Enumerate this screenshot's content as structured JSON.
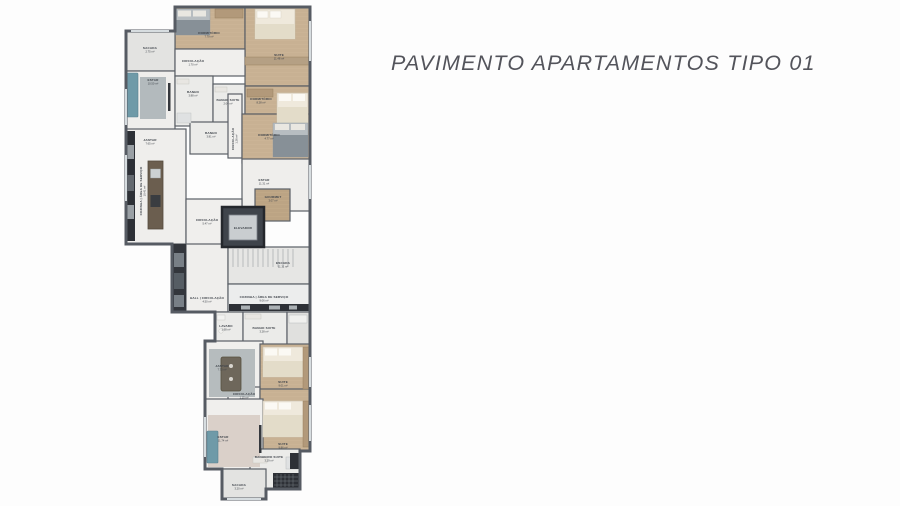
{
  "title": "PAVIMENTO APARTAMENTOS TIPO 01",
  "floorplan": {
    "rooms": [
      {
        "name": "SACADA",
        "area": "2.75 m²"
      },
      {
        "name": "DORMITÓRIO",
        "area": "7.79 m²"
      },
      {
        "name": "SUITE",
        "area": "11.48 m²"
      },
      {
        "name": "CIRCULAÇÃO",
        "area": "1.70 m²"
      },
      {
        "name": "ESTAR",
        "area": "10.50 m²"
      },
      {
        "name": "BANHO",
        "area": "3.88 m²"
      },
      {
        "name": "BANHO SUITE",
        "area": "2.04 m²"
      },
      {
        "name": "DORMITÓRIO",
        "area": "8.28 m²"
      },
      {
        "name": "JANTAR",
        "area": "7.65 m²"
      },
      {
        "name": "BANHO",
        "area": "3.81 m²"
      },
      {
        "name": "CIRCULAÇÃO",
        "area": "1.26 m²"
      },
      {
        "name": "DORMITÓRIO",
        "area": "4.77 m²"
      },
      {
        "name": "COZINHA | ÁREA DE SERVIÇO",
        "area": "10.41 m²"
      },
      {
        "name": "ESTAR",
        "area": "11.31 m²"
      },
      {
        "name": "GOURMET",
        "area": "3.07 m²"
      },
      {
        "name": "CIRCULAÇÃO",
        "area": "5.47 m²"
      },
      {
        "name": "ELEVADOR",
        "area": ""
      },
      {
        "name": "ESCADA",
        "area": "11.11 m²"
      },
      {
        "name": "COZINHA | ÁREA DE SERVIÇO",
        "area": "9.06 m²"
      },
      {
        "name": "HALL | CIRCULAÇÃO",
        "area": "4.50 m²"
      },
      {
        "name": "LAVABO",
        "area": "1.68 m²"
      },
      {
        "name": "BANHO SUITE",
        "area": "3.28 m²"
      },
      {
        "name": "JANTAR",
        "area": "7.73 m²"
      },
      {
        "name": "SUITE",
        "area": "9.01 m²"
      },
      {
        "name": "CIRCULAÇÃO",
        "area": "1.15 m²"
      },
      {
        "name": "SUITE",
        "area": "9.86 m²"
      },
      {
        "name": "ESTAR",
        "area": "11.74 m²"
      },
      {
        "name": "BANHEIRO SUITE",
        "area": "3.29 m²"
      },
      {
        "name": "SACADA",
        "area": "3.20 m²"
      }
    ],
    "colors": {
      "wall": "#565b63",
      "wood_floor": "#cbb496",
      "tile_floor": "#efeeec",
      "balcony_floor": "#e3e3e1",
      "accent_teal": "#6f9aa8",
      "dark_counter": "#2d3036",
      "title_text": "#53545b"
    }
  }
}
